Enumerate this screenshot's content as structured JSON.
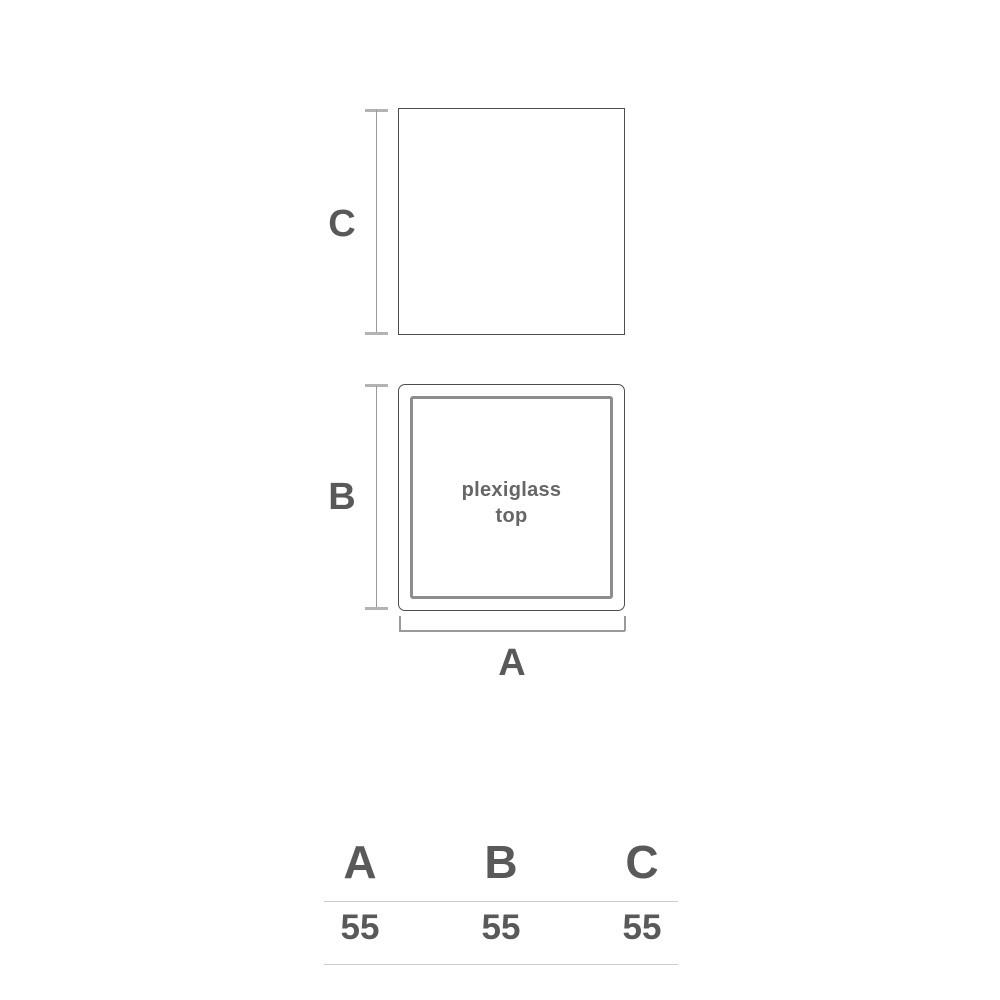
{
  "diagram": {
    "side_view": {
      "dim_label": "C"
    },
    "top_view": {
      "dim_label_height": "B",
      "dim_label_width": "A",
      "surface_text_line1": "plexiglass",
      "surface_text_line2": "top"
    },
    "colors": {
      "outline": "#4d4d4d",
      "inner_frame": "#8d8d8d",
      "dimension_line": "#9a9a9a",
      "dimension_tick": "#b3b3b3",
      "label_text": "#595959",
      "surface_text": "#666666",
      "table_rule": "#cccccc"
    }
  },
  "dimensions_table": {
    "columns": [
      "A",
      "B",
      "C"
    ],
    "values": [
      "55",
      "55",
      "55"
    ]
  }
}
